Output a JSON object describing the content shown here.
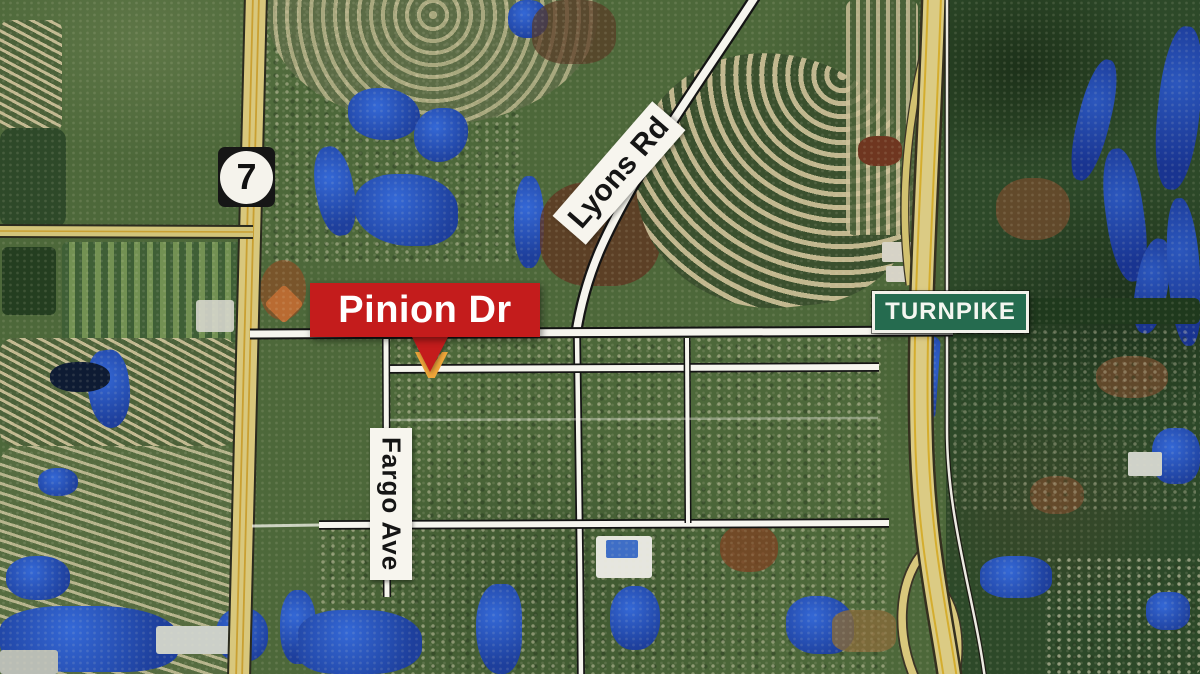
{
  "labels": {
    "pinion_dr": "Pinion Dr",
    "lyons_rd": "Lyons Rd",
    "turnpike": "TURNPIKE",
    "fargo_ave": "Fargo Ave",
    "route_7": "7"
  },
  "colors": {
    "callout_red": "#c41c1c",
    "callout_text": "#ffffff",
    "marker_orange": "#efa63a",
    "turnpike_sign_green": "#256b4f",
    "turnpike_sign_text": "#f4f6f0",
    "road_label_bg": "#f7f5ee",
    "road_label_text": "#151515",
    "shield_bg": "#161616",
    "shield_circle": "#f5f3ec",
    "shield_text": "#111111"
  }
}
